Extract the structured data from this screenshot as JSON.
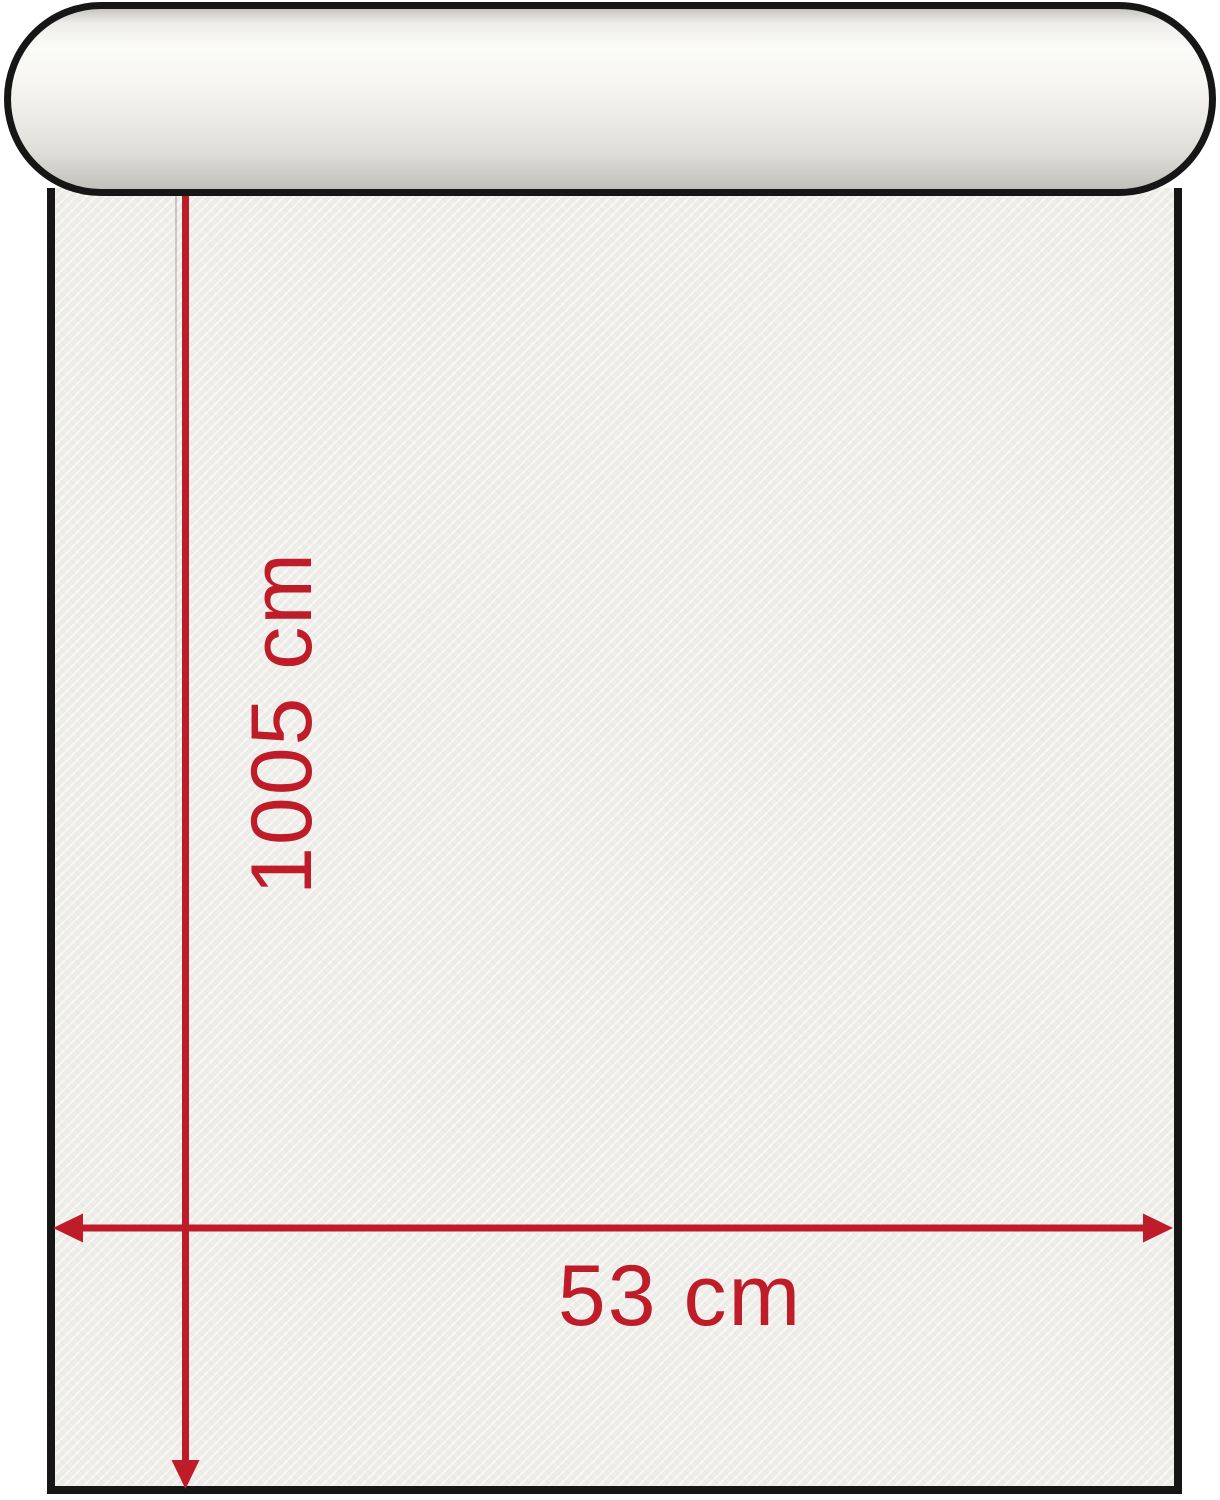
{
  "diagram": {
    "height_label": "1005 cm",
    "width_label": "53 cm",
    "height_value_cm": 1005,
    "width_value_cm": 53,
    "colors": {
      "dimension_red": "#bf1c29",
      "outline_black": "#161616",
      "paper_white": "#f1f0ec"
    }
  }
}
